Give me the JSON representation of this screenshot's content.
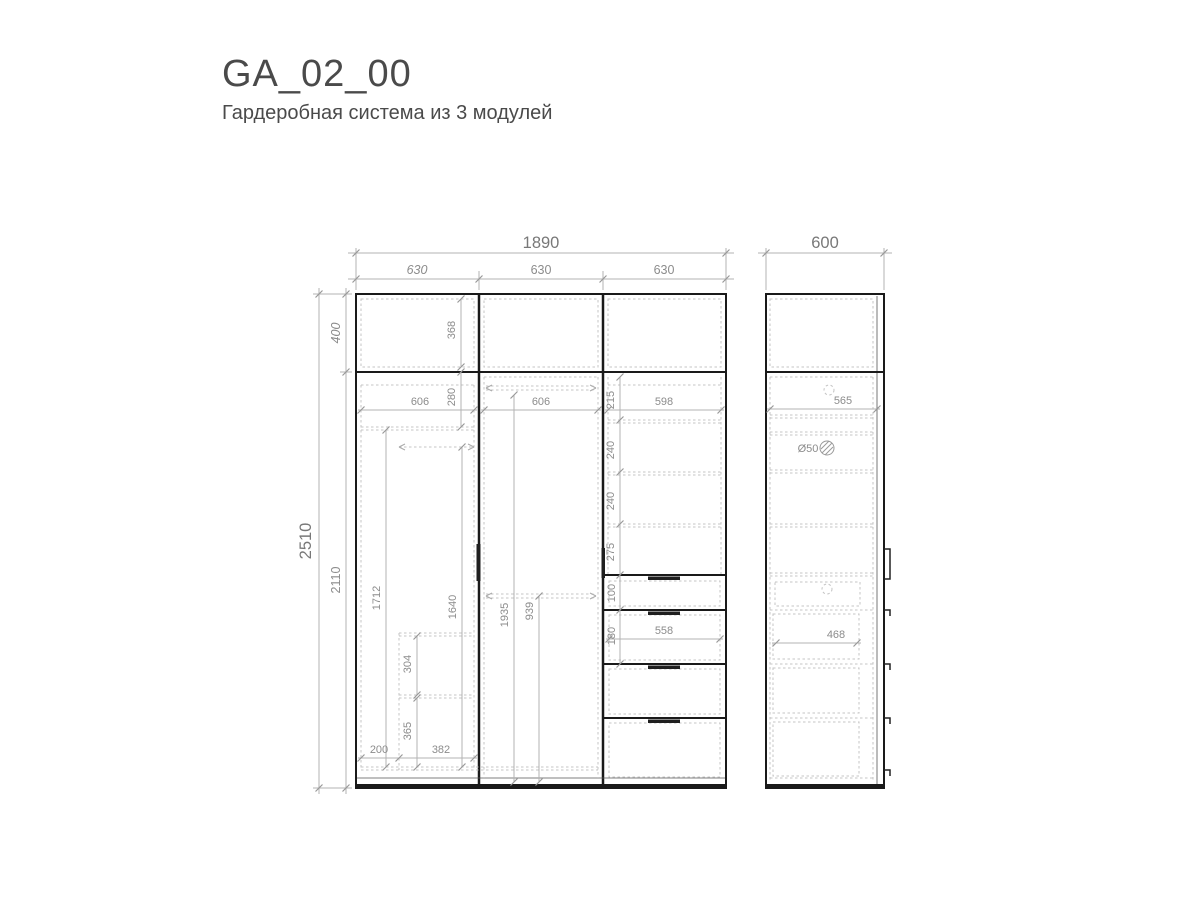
{
  "title": "GA_02_00",
  "subtitle": "Гардеробная система из 3 модулей",
  "colors": {
    "outline": "#1a1a1a",
    "dashed_line": "#c4c4c4",
    "dimension_line": "#b3b3b3",
    "dimension_text": "#8c8c8c",
    "title_text": "#4a4a4a"
  },
  "front_view": {
    "overall_width": "1890",
    "module_widths": [
      "630",
      "630",
      "630"
    ],
    "overall_height": "2510",
    "top_section_height": "400",
    "main_section_height": "2110",
    "top_section": {
      "inner_height": "368"
    },
    "left_module": {
      "inner_width": "606",
      "top_shelf_height": "280",
      "height_left": "1712",
      "height_right": "1640",
      "shelf_gap_upper": "304",
      "shelf_gap_lower": "365",
      "bottom_width_left": "200",
      "bottom_width_right": "382"
    },
    "middle_module": {
      "inner_width": "606",
      "door_inner_height": "1935",
      "rod_height": "939"
    },
    "right_module": {
      "inner_width": "598",
      "shelf_gap_1": "215",
      "shelf_gap_2": "240",
      "shelf_gap_3": "240",
      "shelf_gap_4": "275",
      "drawer_front_1": "100",
      "drawer_front_2": "180",
      "drawer_inner_width": "558"
    }
  },
  "side_view": {
    "depth": "600",
    "inner_depth": "565",
    "hole_diameter": "Ø50",
    "drawer_inner_depth": "468"
  }
}
